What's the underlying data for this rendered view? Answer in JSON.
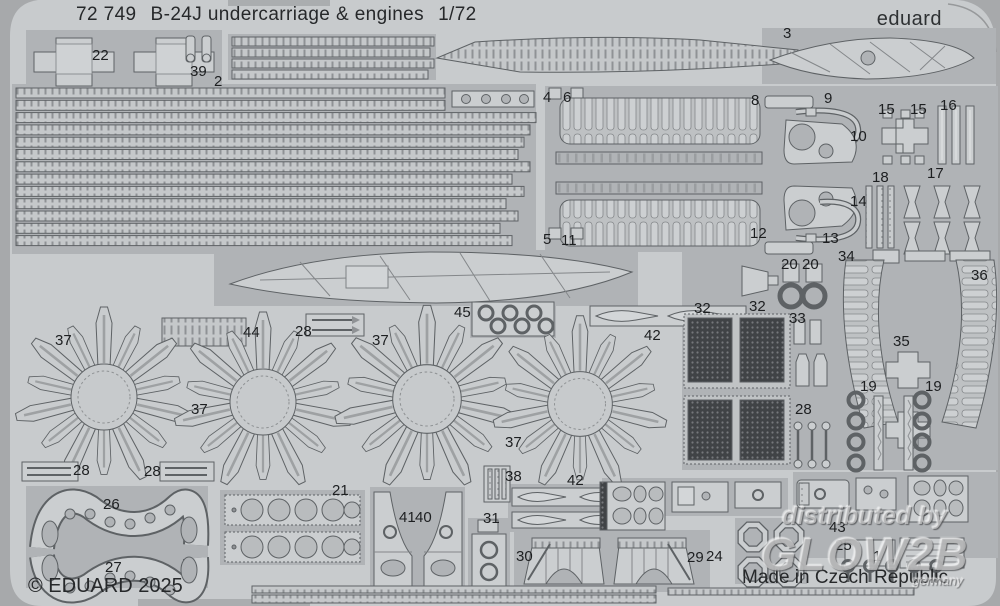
{
  "sheet": {
    "code": "72 749",
    "title": "B-24J undercarriage & engines",
    "scale": "1/72",
    "brand": "eduard",
    "copyright": "© EDUARD 2025",
    "made_in": "Made in Czech Republic"
  },
  "watermark": {
    "line1": "distributed by",
    "line2": "GLOW2B",
    "line3": "germany"
  },
  "colors": {
    "background": "#a7a9ab",
    "sheet_base": "#c8cbcd",
    "etched_region": "#b0b3b6",
    "part_fill": "#cbced0",
    "part_outline": "#5e6265",
    "mesh_dark": "#404346",
    "text": "#26282a"
  },
  "part_labels": [
    {
      "n": "22",
      "x": 92,
      "y": 48
    },
    {
      "n": "39",
      "x": 190,
      "y": 64
    },
    {
      "n": "2",
      "x": 214,
      "y": 74
    },
    {
      "n": "3",
      "x": 783,
      "y": 26
    },
    {
      "n": "4",
      "x": 543,
      "y": 90
    },
    {
      "n": "6",
      "x": 563,
      "y": 90
    },
    {
      "n": "8",
      "x": 751,
      "y": 93
    },
    {
      "n": "9",
      "x": 824,
      "y": 91
    },
    {
      "n": "15",
      "x": 878,
      "y": 102
    },
    {
      "n": "15",
      "x": 910,
      "y": 102
    },
    {
      "n": "16",
      "x": 940,
      "y": 98
    },
    {
      "n": "10",
      "x": 850,
      "y": 129
    },
    {
      "n": "18",
      "x": 872,
      "y": 170
    },
    {
      "n": "17",
      "x": 927,
      "y": 166
    },
    {
      "n": "14",
      "x": 850,
      "y": 194
    },
    {
      "n": "12",
      "x": 750,
      "y": 226
    },
    {
      "n": "13",
      "x": 822,
      "y": 231
    },
    {
      "n": "5",
      "x": 543,
      "y": 232
    },
    {
      "n": "11",
      "x": 561,
      "y": 233
    },
    {
      "n": "34",
      "x": 838,
      "y": 249
    },
    {
      "n": "20",
      "x": 781,
      "y": 257
    },
    {
      "n": "20",
      "x": 802,
      "y": 257
    },
    {
      "n": "36",
      "x": 971,
      "y": 268
    },
    {
      "n": "32",
      "x": 694,
      "y": 301
    },
    {
      "n": "32",
      "x": 749,
      "y": 299
    },
    {
      "n": "33",
      "x": 789,
      "y": 311
    },
    {
      "n": "42",
      "x": 644,
      "y": 328
    },
    {
      "n": "35",
      "x": 893,
      "y": 334
    },
    {
      "n": "19",
      "x": 860,
      "y": 379
    },
    {
      "n": "19",
      "x": 925,
      "y": 379
    },
    {
      "n": "28",
      "x": 795,
      "y": 402
    },
    {
      "n": "37",
      "x": 55,
      "y": 333
    },
    {
      "n": "44",
      "x": 243,
      "y": 325
    },
    {
      "n": "28",
      "x": 295,
      "y": 324
    },
    {
      "n": "37",
      "x": 372,
      "y": 333
    },
    {
      "n": "45",
      "x": 454,
      "y": 305
    },
    {
      "n": "37",
      "x": 191,
      "y": 402
    },
    {
      "n": "37",
      "x": 505,
      "y": 435
    },
    {
      "n": "38",
      "x": 505,
      "y": 469
    },
    {
      "n": "42",
      "x": 567,
      "y": 473
    },
    {
      "n": "41",
      "x": 399,
      "y": 510
    },
    {
      "n": "40",
      "x": 415,
      "y": 510
    },
    {
      "n": "31",
      "x": 483,
      "y": 511
    },
    {
      "n": "30",
      "x": 516,
      "y": 549
    },
    {
      "n": "28",
      "x": 73,
      "y": 463
    },
    {
      "n": "28",
      "x": 144,
      "y": 464
    },
    {
      "n": "26",
      "x": 103,
      "y": 497
    },
    {
      "n": "21",
      "x": 332,
      "y": 483
    },
    {
      "n": "27",
      "x": 105,
      "y": 560
    },
    {
      "n": "29",
      "x": 687,
      "y": 550
    },
    {
      "n": "24",
      "x": 706,
      "y": 549
    },
    {
      "n": "43",
      "x": 829,
      "y": 520
    },
    {
      "n": "25",
      "x": 835,
      "y": 538
    },
    {
      "n": "1",
      "x": 873,
      "y": 549
    }
  ]
}
